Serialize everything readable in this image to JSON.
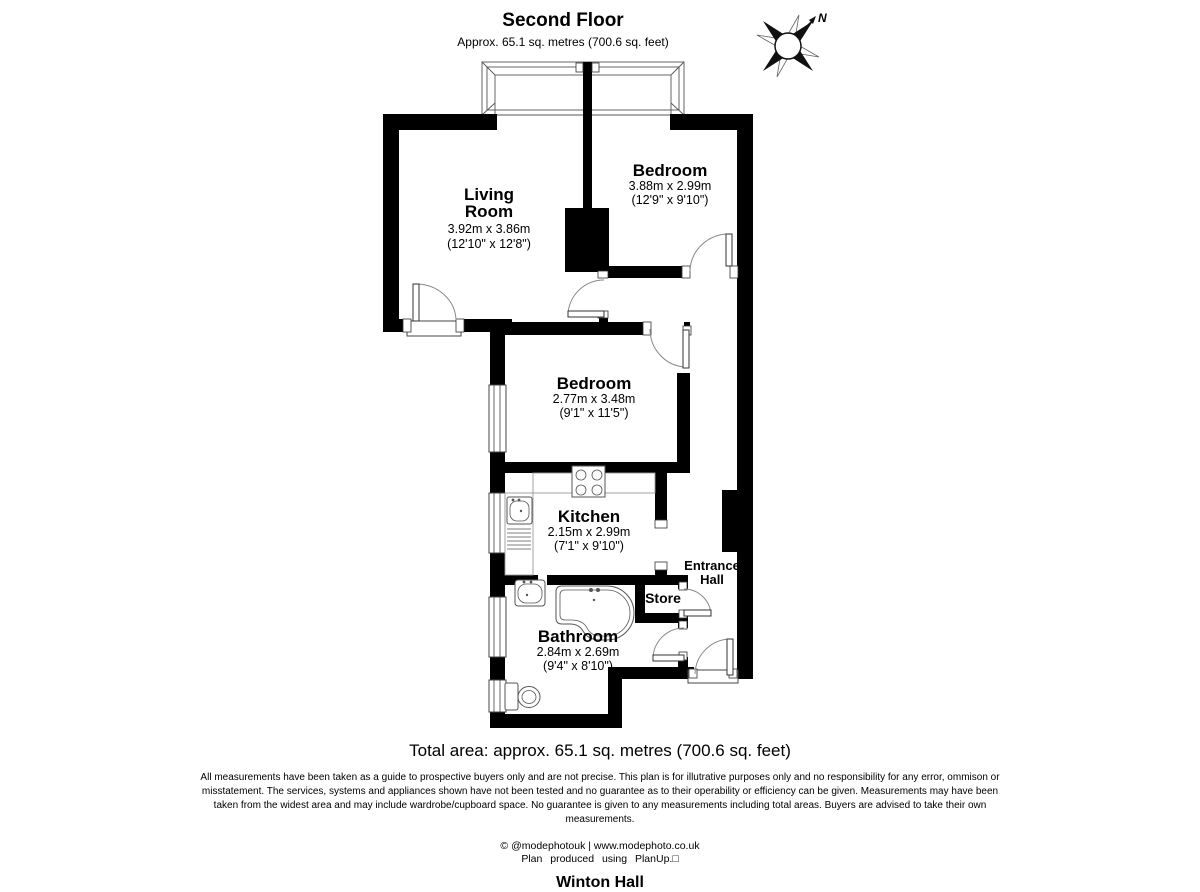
{
  "header": {
    "title": "Second Floor",
    "subtitle": "Approx. 65.1 sq. metres (700.6 sq. feet)"
  },
  "compass": {
    "north_label": "N"
  },
  "rooms": {
    "living_room": {
      "name_line1": "Living",
      "name_line2": "Room",
      "dims_metric": "3.92m x 3.86m",
      "dims_imperial": "(12'10\" x 12'8\")"
    },
    "bedroom1": {
      "name": "Bedroom",
      "dims_metric": "3.88m x 2.99m",
      "dims_imperial": "(12'9\" x 9'10\")"
    },
    "bedroom2": {
      "name": "Bedroom",
      "dims_metric": "2.77m x 3.48m",
      "dims_imperial": "(9'1\" x 11'5\")"
    },
    "kitchen": {
      "name": "Kitchen",
      "dims_metric": "2.15m x 2.99m",
      "dims_imperial": "(7'1\" x 9'10\")"
    },
    "bathroom": {
      "name": "Bathroom",
      "dims_metric": "2.84m x 2.69m",
      "dims_imperial": "(9'4\" x 8'10\")"
    },
    "store": {
      "name": "Store"
    },
    "entrance_hall": {
      "name_line1": "Entrance",
      "name_line2": "Hall"
    }
  },
  "footer": {
    "total_area": "Total area: approx. 65.1 sq. metres (700.6 sq. feet)",
    "disclaimer_lines": [
      "All measurements have been taken as a guide to prospective buyers only and are not precise. This plan is for illutrative purposes only and no responsibility for any error, ommison or",
      "misstatement. The services, systems and appliances shown have not been tested and no guarantee as to their operability or efficiency can be given. Measurements may have been",
      "taken from the widest area and may include wardrobe/cupboard space. No guarantee is given to any measurements including total areas. Buyers are advised to take their own",
      "measurements."
    ],
    "credit_line1": "© @modephotouk | www.modephoto.co.uk",
    "credit_line2": "Plan  produced  using  PlanUp.□",
    "building_name": "Winton Hall"
  }
}
